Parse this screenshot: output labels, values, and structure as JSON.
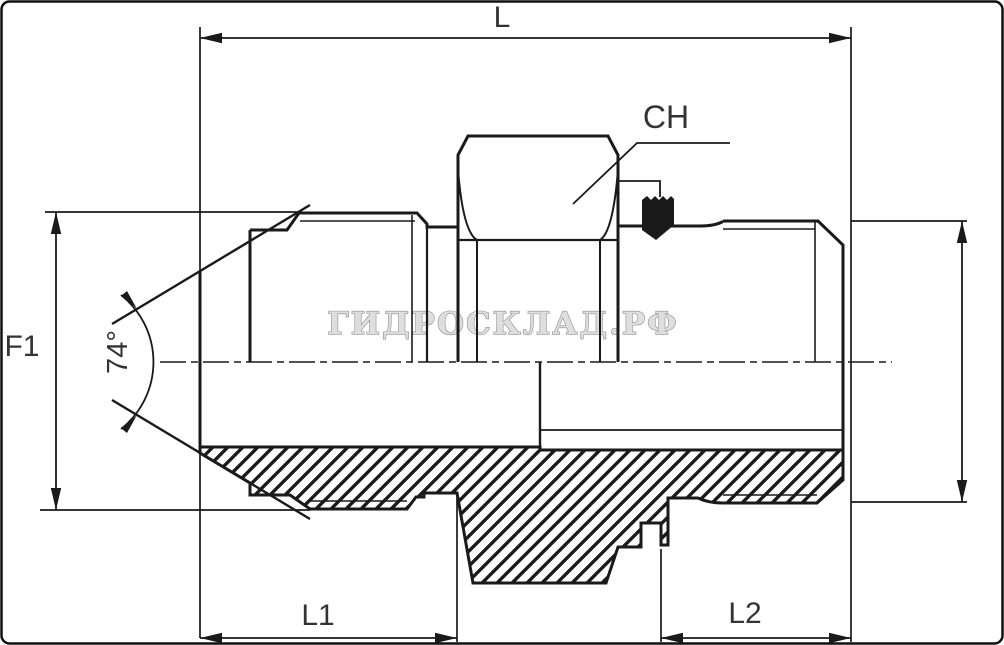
{
  "drawing": {
    "type": "technical-drawing",
    "subject": "hydraulic adapter fitting half-section",
    "watermark": "ГИДРОСКЛАД.РФ",
    "labels": {
      "overall_length": "L",
      "flare_size": "F1",
      "flare_angle": "74°",
      "wrench_size": "CH",
      "left_length": "L1",
      "right_length": "L2"
    },
    "colors": {
      "line": "#1a1a1a",
      "dimension_text": "#333333",
      "watermark_stroke": "#8f8f8f",
      "watermark_fill": "#dedede",
      "background": "#ffffff"
    }
  }
}
